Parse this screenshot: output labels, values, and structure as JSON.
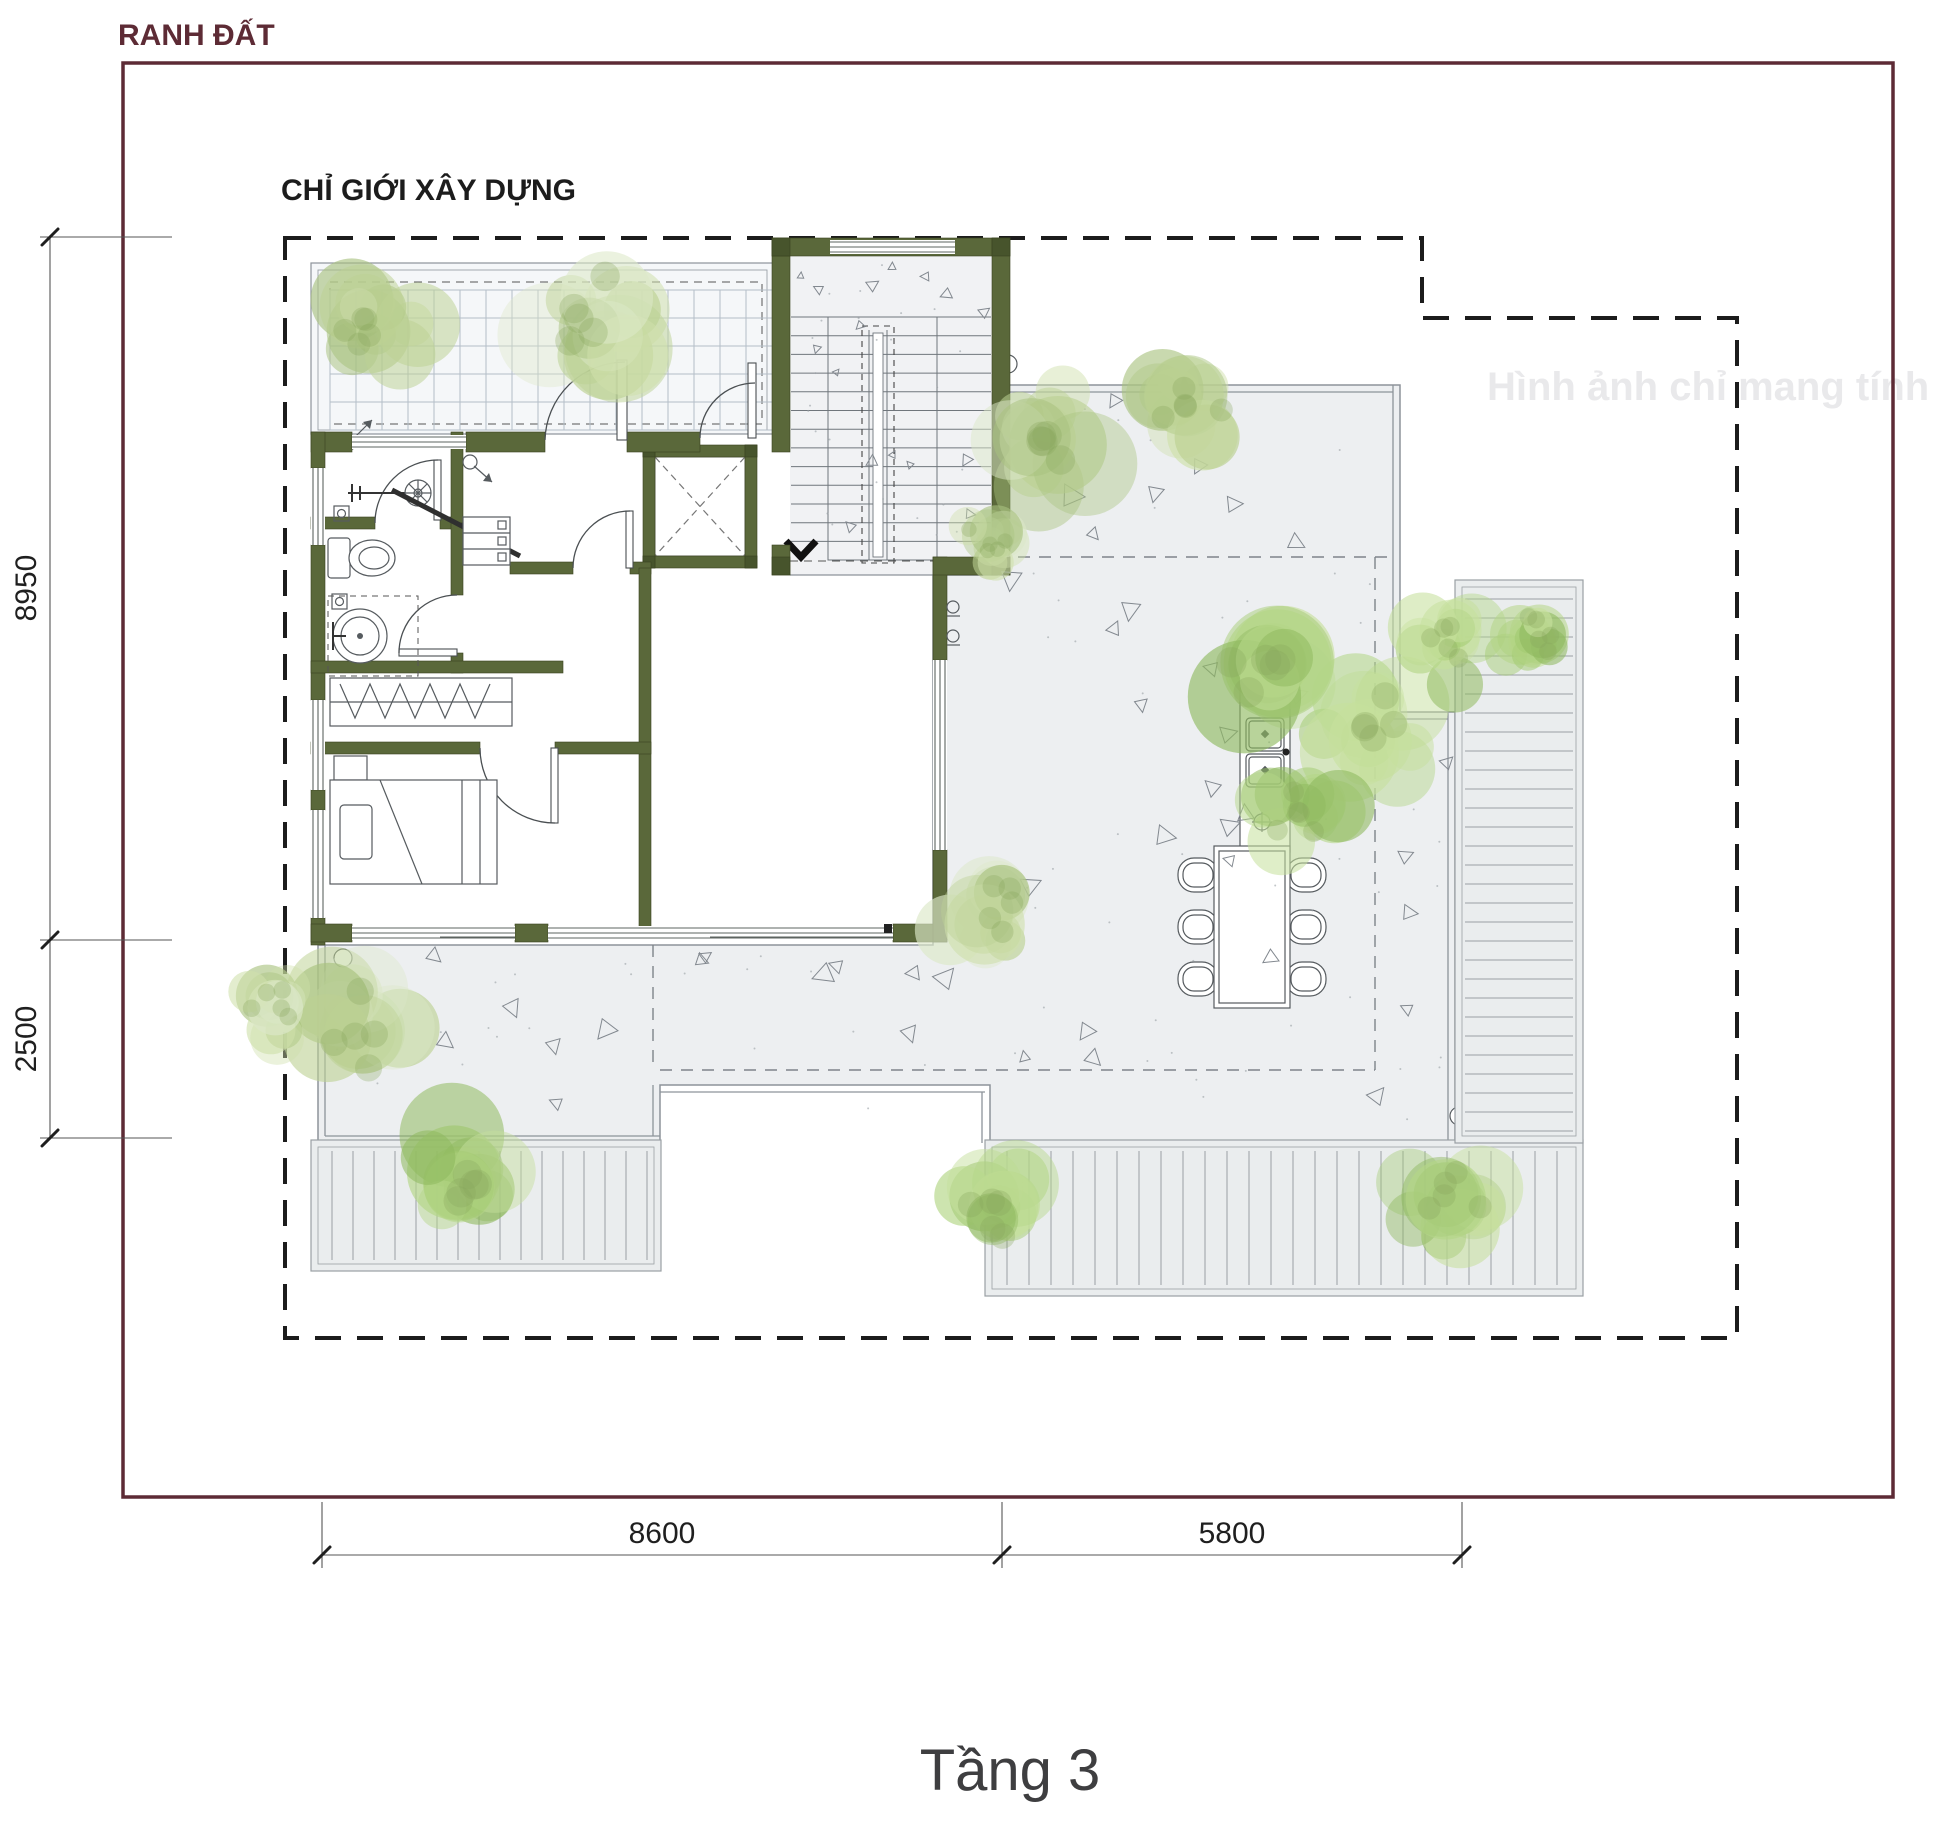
{
  "labels": {
    "land_boundary": "RANH ĐẤT",
    "setback": "CHỈ GIỚI XÂY DỰNG",
    "floor_title": "Tầng 3",
    "watermark": "Hình ảnh chỉ mang tính ch"
  },
  "dimensions": {
    "left": [
      {
        "value": "8950"
      },
      {
        "value": "2500"
      }
    ],
    "bottom": [
      {
        "value": "8600"
      },
      {
        "value": "5800"
      }
    ]
  },
  "colors": {
    "boundary": "#5d2b35",
    "setback_line": "#1c1c1c",
    "wall": "#5a683a",
    "wall_dark": "#47542c",
    "terrace": "#edeff1",
    "deck_line": "#9aa0a4",
    "tile_grid": "#b4bdc7",
    "foliage": "#b7d68e",
    "title_text": "#3e3e40",
    "watermark_text": "#e9e9eb"
  }
}
